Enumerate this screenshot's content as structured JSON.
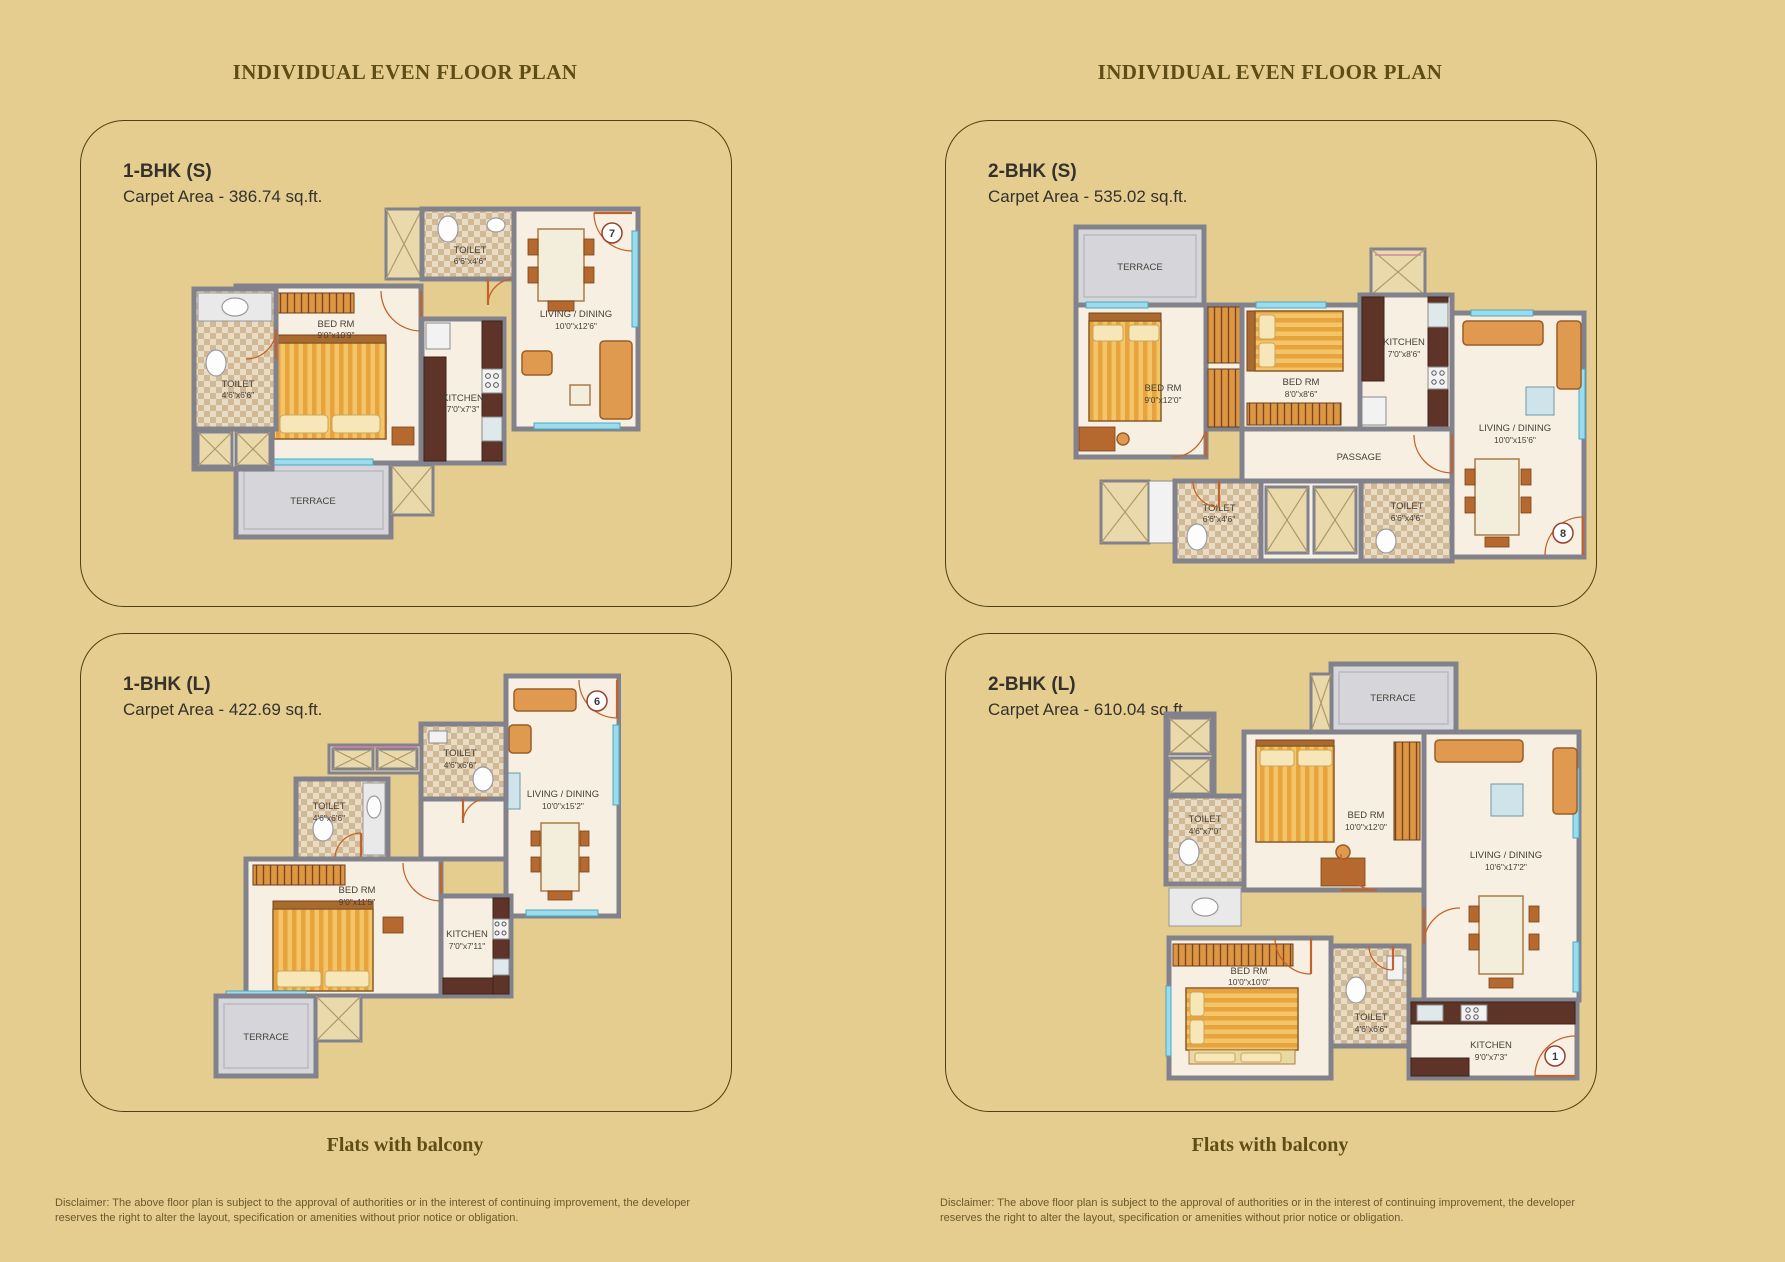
{
  "page": {
    "background": "#e5cd8f",
    "header_color": "#5e4d15",
    "title_color": "#35312b"
  },
  "columns": [
    {
      "header": "INDIVIDUAL EVEN FLOOR PLAN",
      "tagline": "Flats with balcony",
      "disclaimer": "Disclaimer: The above floor plan is subject to the approval of authorities or in the interest of continuing improvement, the developer reserves the right to alter the layout, specification or amenities without prior notice or obligation.",
      "panels": [
        {
          "unit_type": "1-BHK (S)",
          "carpet_area": "Carpet Area - 386.74 sq.ft.",
          "unit_number": "7",
          "rooms": {
            "toilet_top": {
              "name": "TOILET",
              "dims": "6'6\"x4'6\""
            },
            "toilet_left": {
              "name": "TOILET",
              "dims": "4'6\"x6'6\""
            },
            "bedroom": {
              "name": "BED RM",
              "dims": "9'0\"x10'9\""
            },
            "kitchen": {
              "name": "KITCHEN",
              "dims": "7'0\"x7'3\""
            },
            "living": {
              "name": "LIVING / DINING",
              "dims": "10'0\"x12'6\""
            },
            "terrace": {
              "name": "TERRACE"
            }
          }
        },
        {
          "unit_type": "1-BHK (L)",
          "carpet_area": "Carpet Area - 422.69 sq.ft.",
          "unit_number": "6",
          "rooms": {
            "toilet_top": {
              "name": "TOILET",
              "dims": "4'6\"x6'6\""
            },
            "toilet_left": {
              "name": "TOILET",
              "dims": "4'6\"x6'6\""
            },
            "bedroom": {
              "name": "BED RM",
              "dims": "9'0\"x11'5\""
            },
            "kitchen": {
              "name": "KITCHEN",
              "dims": "7'0\"x7'11\""
            },
            "living": {
              "name": "LIVING / DINING",
              "dims": "10'0\"x15'2\""
            },
            "terrace": {
              "name": "TERRACE"
            }
          }
        }
      ]
    },
    {
      "header": "INDIVIDUAL EVEN FLOOR PLAN",
      "tagline": "Flats with balcony",
      "disclaimer": "Disclaimer: The above floor plan is subject to the approval of authorities or in the interest of continuing improvement, the developer reserves the right to alter the layout, specification or amenities without prior notice or obligation.",
      "panels": [
        {
          "unit_type": "2-BHK (S)",
          "carpet_area": "Carpet Area - 535.02 sq.ft.",
          "unit_number": "8",
          "rooms": {
            "terrace": {
              "name": "TERRACE"
            },
            "bedroom1": {
              "name": "BED RM",
              "dims": "9'0\"x12'0\""
            },
            "bedroom2": {
              "name": "BED RM",
              "dims": "8'0\"x8'6\""
            },
            "kitchen": {
              "name": "KITCHEN",
              "dims": "7'0\"x8'6\""
            },
            "living": {
              "name": "LIVING / DINING",
              "dims": "10'0\"x15'6\""
            },
            "passage": {
              "name": "PASSAGE"
            },
            "toilet1": {
              "name": "TOILET",
              "dims": "6'6\"x4'6\""
            },
            "toilet2": {
              "name": "TOILET",
              "dims": "6'6\"x4'6\""
            }
          }
        },
        {
          "unit_type": "2-BHK (L)",
          "carpet_area": "Carpet Area - 610.04 sq.ft.",
          "unit_number": "1",
          "rooms": {
            "terrace": {
              "name": "TERRACE"
            },
            "toilet_top": {
              "name": "TOILET",
              "dims": "4'6\"x7'0\""
            },
            "bedroom1": {
              "name": "BED RM",
              "dims": "10'0\"x12'0\""
            },
            "bedroom2": {
              "name": "BED RM",
              "dims": "10'0\"x10'0\""
            },
            "living": {
              "name": "LIVING / DINING",
              "dims": "10'6\"x17'2\""
            },
            "toilet_bottom": {
              "name": "TOILET",
              "dims": "4'6\"x6'6\""
            },
            "kitchen": {
              "name": "KITCHEN",
              "dims": "9'0\"x7'3\""
            }
          }
        }
      ]
    }
  ]
}
